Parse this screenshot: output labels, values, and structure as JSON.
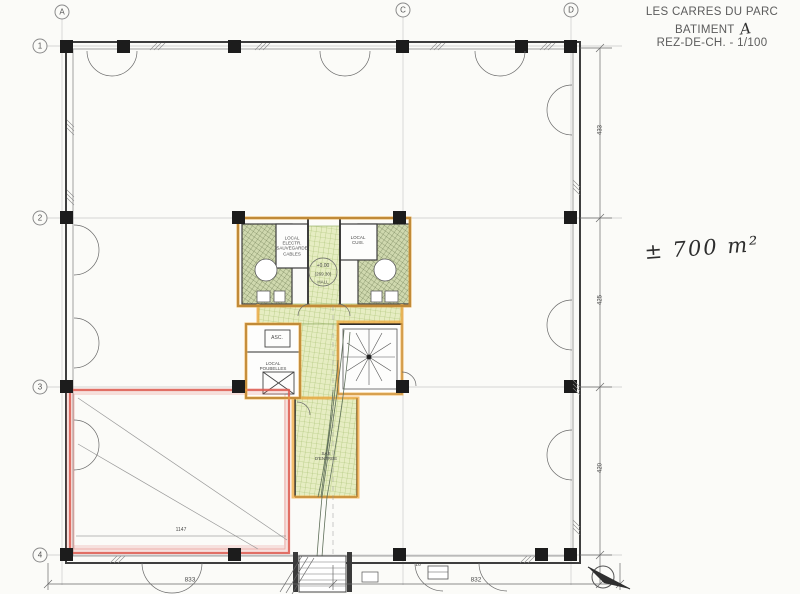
{
  "title_block": {
    "project": "LES CARRES DU PARC",
    "building_label": "BATIMENT",
    "building_mark": "A",
    "level_label": "REZ-DE-CH. - 1/100"
  },
  "annotations": {
    "area_note": "± 700 m²"
  },
  "grid": {
    "columns": [
      {
        "label": "A"
      },
      {
        "label": "C"
      },
      {
        "label": "D"
      }
    ],
    "rows": [
      {
        "label": "1"
      },
      {
        "label": "2"
      },
      {
        "label": "3"
      },
      {
        "label": "4"
      }
    ]
  },
  "rooms": {
    "electrical": "LOCAL\nELECTR.\nSAUVEGARDE\nCABLES",
    "cuisine": "LOCAL\nCUIS.",
    "elevator": "ASC.",
    "trash": "LOCAL\nPOUBELLES",
    "entry_airlock": "SAS\nD'ENTREE",
    "hall": "HALL",
    "level_mark": "+0.00",
    "level_value": "(269.30)"
  },
  "dimensions": {
    "bottom_left": "833",
    "bottom_right": "832",
    "room_width": "1147",
    "right_top": "433",
    "right_middle": "425",
    "right_bottom": "420",
    "door_width": "16"
  },
  "colors": {
    "highlight_orange": "#f2a93c",
    "highlight_red": "#dd5a50",
    "highlight_green": "#e6edc2"
  }
}
